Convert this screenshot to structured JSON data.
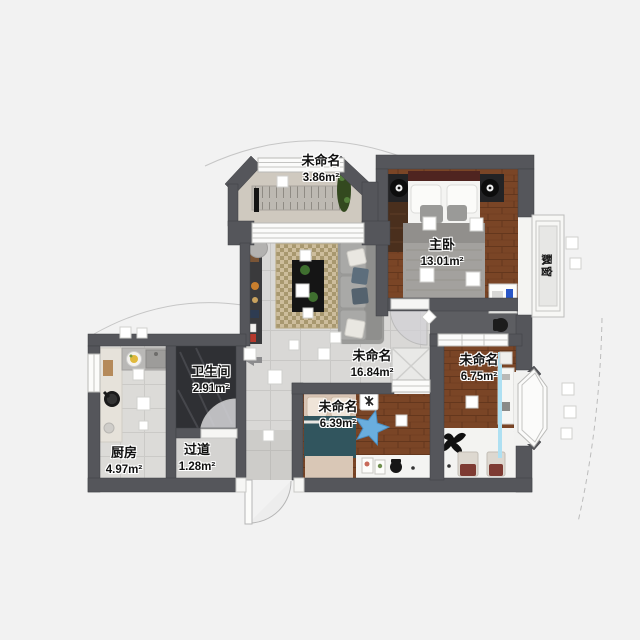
{
  "app": {
    "view": "floor-plan-2d"
  },
  "rooms": [
    {
      "key": "balcony_top",
      "name": "未命名",
      "area": "3.86m²"
    },
    {
      "key": "master_bedroom",
      "name": "主卧",
      "area": "13.01m²"
    },
    {
      "key": "living",
      "name": "未命名",
      "area": "16.84m²"
    },
    {
      "key": "bathroom",
      "name": "卫生间",
      "area": "2.91m²"
    },
    {
      "key": "kitchen",
      "name": "厨房",
      "area": "4.97m²"
    },
    {
      "key": "hallway",
      "name": "过道",
      "area": "1.28m²"
    },
    {
      "key": "bedroom_small",
      "name": "未命名",
      "area": "6.39m²"
    },
    {
      "key": "bedroom_right",
      "name": "未命名",
      "area": "6.75m²"
    }
  ],
  "bay_window_label": "飘窗",
  "palette": {
    "background": "#f2f2f2",
    "wall": "#55565b",
    "wood_floor": "#7a4526",
    "tile_floor": "#d9d8d6",
    "bathroom_floor": "#2f3034",
    "balcony_floor": "#cfc9bf",
    "corridor_floor": "#5d5e62",
    "star_rug_blue": "#6aaede",
    "teal_bedding": "#31555e",
    "laptop_blue": "#2a57c8",
    "glass_blue": "#aee0f2",
    "maroon_headboard": "#4f2420"
  }
}
